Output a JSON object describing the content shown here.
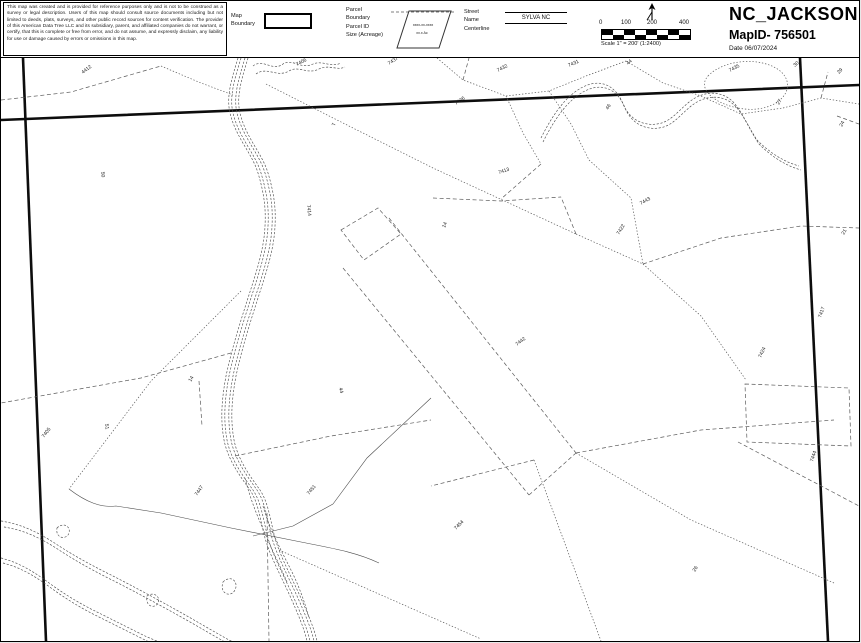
{
  "header": {
    "disclaimer": "This map was created and is provided for reference purposes only and is not to be construed as a survey or legal description. Users of this map should consult source documents including but not limited to deeds, plats, surveys, and other public record sources for content verification. The provider of this American Data Tree LLC and its subsidiary, parent, and affiliated companies do not warrant, or certify, that this is complete or free from error, and do not assume, and expressly disclaim, any liability for use or damage caused by errors or omissions in this map.",
    "legend": {
      "map_boundary_lines": [
        "Map",
        "Boundary"
      ],
      "parcel_lines": [
        "Parcel",
        "Boundary",
        "Parcel ID",
        "Size (Acreage)"
      ],
      "parcel_sample_id": "xxxx-xx-xxxx",
      "parcel_sample_size": "xx.x Ac",
      "street_lines": [
        "Street",
        "Name",
        "Centerline"
      ],
      "street_sample": "SYLVA NC"
    },
    "scale": {
      "ticks": [
        "0",
        "100",
        "200",
        "400"
      ],
      "caption": "Scale 1\" = 200'  (1:2400)"
    },
    "title": "NC_JACKSON",
    "map_id": "MapID- 756501",
    "date": "Date 06/07/2024"
  },
  "colors": {
    "ink": "#0d0d0d",
    "parcel_line": "#5a5a5a",
    "label": "#222222"
  },
  "map": {
    "labels": [
      {
        "t": "4412",
        "x": 82,
        "y": 16,
        "r": -38
      },
      {
        "t": "7406",
        "x": 296,
        "y": 8,
        "r": -28
      },
      {
        "t": "7437",
        "x": 388,
        "y": 7,
        "r": -32
      },
      {
        "t": "7432",
        "x": 497,
        "y": 14,
        "r": -28
      },
      {
        "t": "7431",
        "x": 568,
        "y": 9,
        "r": -24
      },
      {
        "t": "44",
        "x": 627,
        "y": 7,
        "r": -40
      },
      {
        "t": "7435",
        "x": 729,
        "y": 14,
        "r": -28
      },
      {
        "t": "30",
        "x": 794,
        "y": 9,
        "r": -42
      },
      {
        "t": "29",
        "x": 838,
        "y": 16,
        "r": -46
      },
      {
        "t": "27",
        "x": 778,
        "y": 47,
        "r": -60
      },
      {
        "t": "24",
        "x": 841,
        "y": 69,
        "r": -62
      },
      {
        "t": "46",
        "x": 607,
        "y": 52,
        "r": -58
      },
      {
        "t": "7436",
        "x": 455,
        "y": 47,
        "r": -34
      },
      {
        "t": "7",
        "x": 334,
        "y": 68,
        "r": -78
      },
      {
        "t": "50",
        "x": 100,
        "y": 114,
        "r": 82
      },
      {
        "t": "7413",
        "x": 498,
        "y": 116,
        "r": -18
      },
      {
        "t": "7443",
        "x": 640,
        "y": 147,
        "r": -30
      },
      {
        "t": "7414",
        "x": 306,
        "y": 147,
        "r": 84
      },
      {
        "t": "14",
        "x": 444,
        "y": 170,
        "r": -68
      },
      {
        "t": "7422",
        "x": 618,
        "y": 177,
        "r": -58
      },
      {
        "t": "21",
        "x": 843,
        "y": 177,
        "r": -60
      },
      {
        "t": "7417",
        "x": 820,
        "y": 260,
        "r": -70
      },
      {
        "t": "7424",
        "x": 760,
        "y": 300,
        "r": -65
      },
      {
        "t": "7442",
        "x": 516,
        "y": 288,
        "r": -38
      },
      {
        "t": "44",
        "x": 338,
        "y": 330,
        "r": 76
      },
      {
        "t": "51",
        "x": 104,
        "y": 366,
        "r": 82
      },
      {
        "t": "7405",
        "x": 43,
        "y": 380,
        "r": -52
      },
      {
        "t": "14",
        "x": 190,
        "y": 324,
        "r": -60
      },
      {
        "t": "7447",
        "x": 196,
        "y": 438,
        "r": -55
      },
      {
        "t": "7451",
        "x": 308,
        "y": 437,
        "r": -50
      },
      {
        "t": "7454",
        "x": 455,
        "y": 472,
        "r": -45
      },
      {
        "t": "26",
        "x": 694,
        "y": 514,
        "r": -58
      },
      {
        "t": "7444",
        "x": 812,
        "y": 404,
        "r": -72
      }
    ]
  }
}
